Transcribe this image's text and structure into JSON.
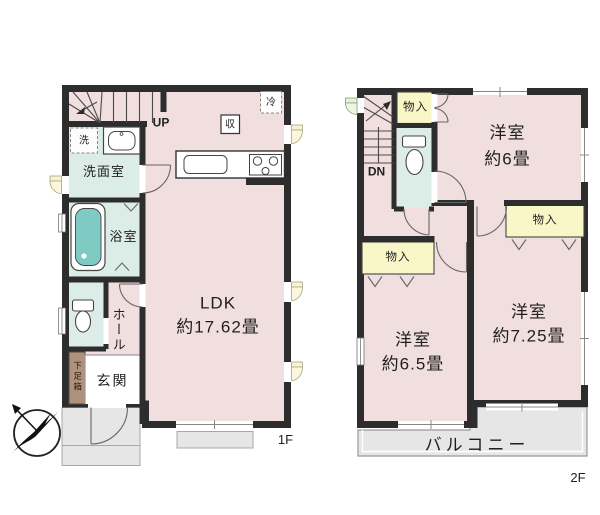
{
  "colors": {
    "room_pink": "#f1dede",
    "wet_green": "#dcece6",
    "closet_yellow": "#f9f6c8",
    "outdoor_gray": "#e6e6e6",
    "bathtub_teal": "#7fcbc4",
    "shoe_brown": "#b2917b",
    "wall": "#2d2d2d",
    "window_yellow": "#f7f3cf",
    "window_green": "#e6f1da"
  },
  "f1": {
    "floor_label": "1F",
    "stair_label": "UP",
    "ldk_name": "LDK",
    "ldk_size": "約17.62畳",
    "washroom": "洗面室",
    "bathroom": "浴室",
    "hall": "ホール",
    "entrance": "玄関",
    "shoe_cabinet": "下足箱",
    "washer": "洗",
    "storage": "収",
    "refrigerator": "冷"
  },
  "f2": {
    "floor_label": "2F",
    "stair_label": "DN",
    "closet_top": "物入",
    "closet_left": "物入",
    "closet_right": "物入",
    "room_a_name": "洋室",
    "room_a_size": "約6畳",
    "room_b_name": "洋室",
    "room_b_size": "約6.5畳",
    "room_c_name": "洋室",
    "room_c_size": "約7.25畳",
    "balcony": "バルコニー"
  }
}
